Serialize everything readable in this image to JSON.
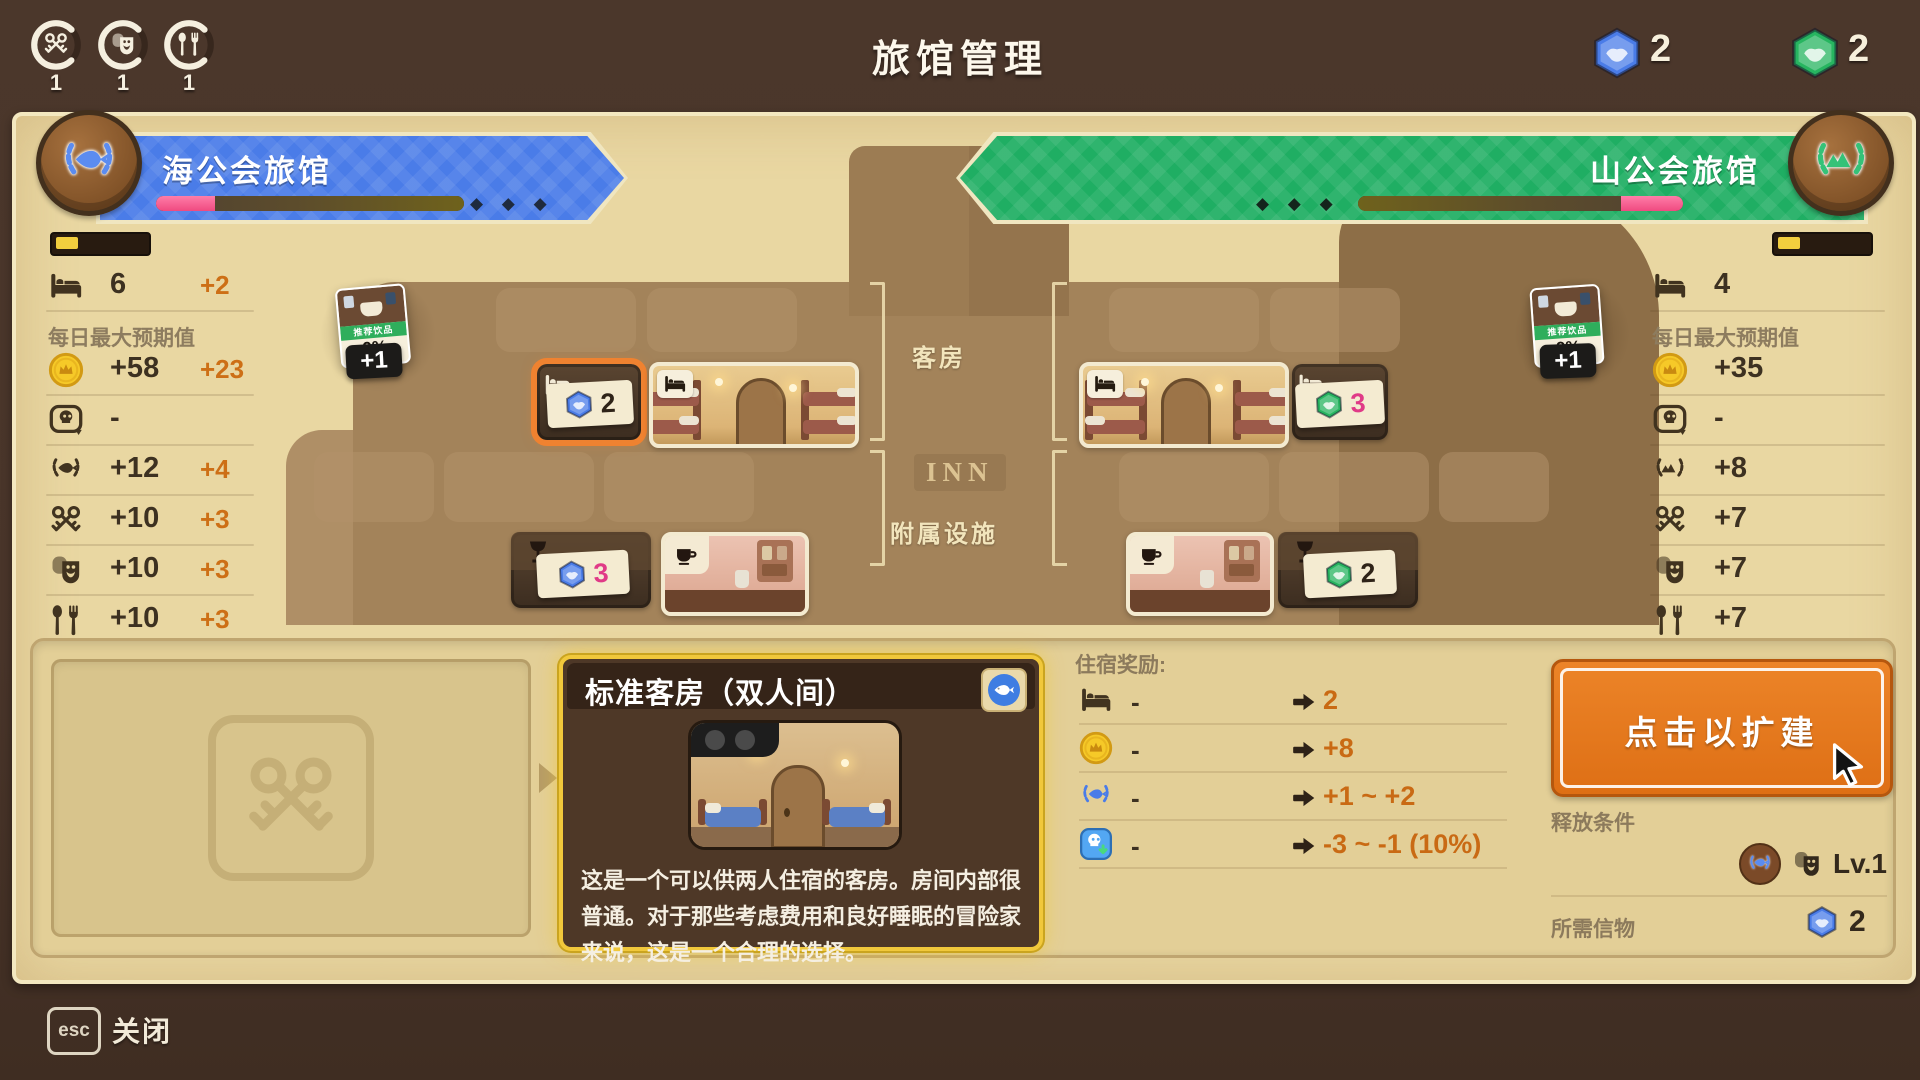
{
  "topbar": {
    "title": "旅馆管理",
    "gauges": [
      {
        "icon": "crossed-keys",
        "value": "1"
      },
      {
        "icon": "theater-masks",
        "value": "1"
      },
      {
        "icon": "dining",
        "value": "1"
      }
    ],
    "tokens": [
      {
        "name": "blue-token",
        "count": "2"
      },
      {
        "name": "green-token",
        "count": "2"
      }
    ]
  },
  "left_inn": {
    "name": "海公会旅馆",
    "diamonds": "◆ ◆ ◆",
    "beds": {
      "value": "6",
      "delta": "+2"
    },
    "expect_label": "每日最大预期值",
    "stats": [
      {
        "icon": "coin",
        "value": "+58",
        "delta": "+23"
      },
      {
        "icon": "skull",
        "value": "-",
        "delta": ""
      },
      {
        "icon": "laurel-fish",
        "value": "+12",
        "delta": "+4"
      },
      {
        "icon": "crossed-keys",
        "value": "+10",
        "delta": "+3"
      },
      {
        "icon": "theater-masks",
        "value": "+10",
        "delta": "+3"
      },
      {
        "icon": "dining",
        "value": "+10",
        "delta": "+3"
      }
    ]
  },
  "right_inn": {
    "name": "山公会旅馆",
    "diamonds": "◆ ◆ ◆",
    "beds": {
      "value": "4",
      "delta": ""
    },
    "expect_label": "每日最大预期值",
    "stats": [
      {
        "icon": "coin",
        "value": "+35",
        "delta": ""
      },
      {
        "icon": "skull",
        "value": "-",
        "delta": ""
      },
      {
        "icon": "laurel-mountain",
        "value": "+8",
        "delta": ""
      },
      {
        "icon": "crossed-keys",
        "value": "+7",
        "delta": ""
      },
      {
        "icon": "theater-masks",
        "value": "+7",
        "delta": ""
      },
      {
        "icon": "dining",
        "value": "+7",
        "delta": ""
      }
    ]
  },
  "building": {
    "rooms_label": "客房",
    "facilities_label": "附属设施",
    "sign": "INN",
    "tags": {
      "left_room": {
        "count": "2"
      },
      "right_room": {
        "count": "3"
      },
      "left_facility": {
        "count": "3"
      },
      "right_facility": {
        "count": "2"
      }
    },
    "drink_card": {
      "label": "推荐饮品",
      "percent": "9%",
      "badge": "+1"
    }
  },
  "detail": {
    "card": {
      "title": "标准客房（双人间）",
      "description": "这是一个可以供两人住宿的客房。房间内部很普通。对于那些考虑费用和良好睡眠的冒险家来说，这是一个合理的选择。"
    },
    "rewards": {
      "header": "住宿奖励:",
      "rows": [
        {
          "icon": "bed",
          "current": "-",
          "result": "2"
        },
        {
          "icon": "coin",
          "current": "-",
          "result": "+8"
        },
        {
          "icon": "laurel-blue",
          "current": "-",
          "result": "+1 ~ +2"
        },
        {
          "icon": "risk",
          "current": "-",
          "result": "-3 ~ -1 (10%)"
        }
      ]
    },
    "action": {
      "button": "点击以扩建",
      "release_label": "释放条件",
      "release_level": "Lv.1",
      "token_label": "所需信物",
      "token_count": "2"
    }
  },
  "footer": {
    "esc": "esc",
    "close": "关闭"
  },
  "colors": {
    "blue": "#4a7ce8",
    "green": "#1fae63",
    "orange": "#e5761e",
    "gold": "#f1c83b",
    "pink": "#f0437c",
    "value_orange": "#c96a14"
  }
}
